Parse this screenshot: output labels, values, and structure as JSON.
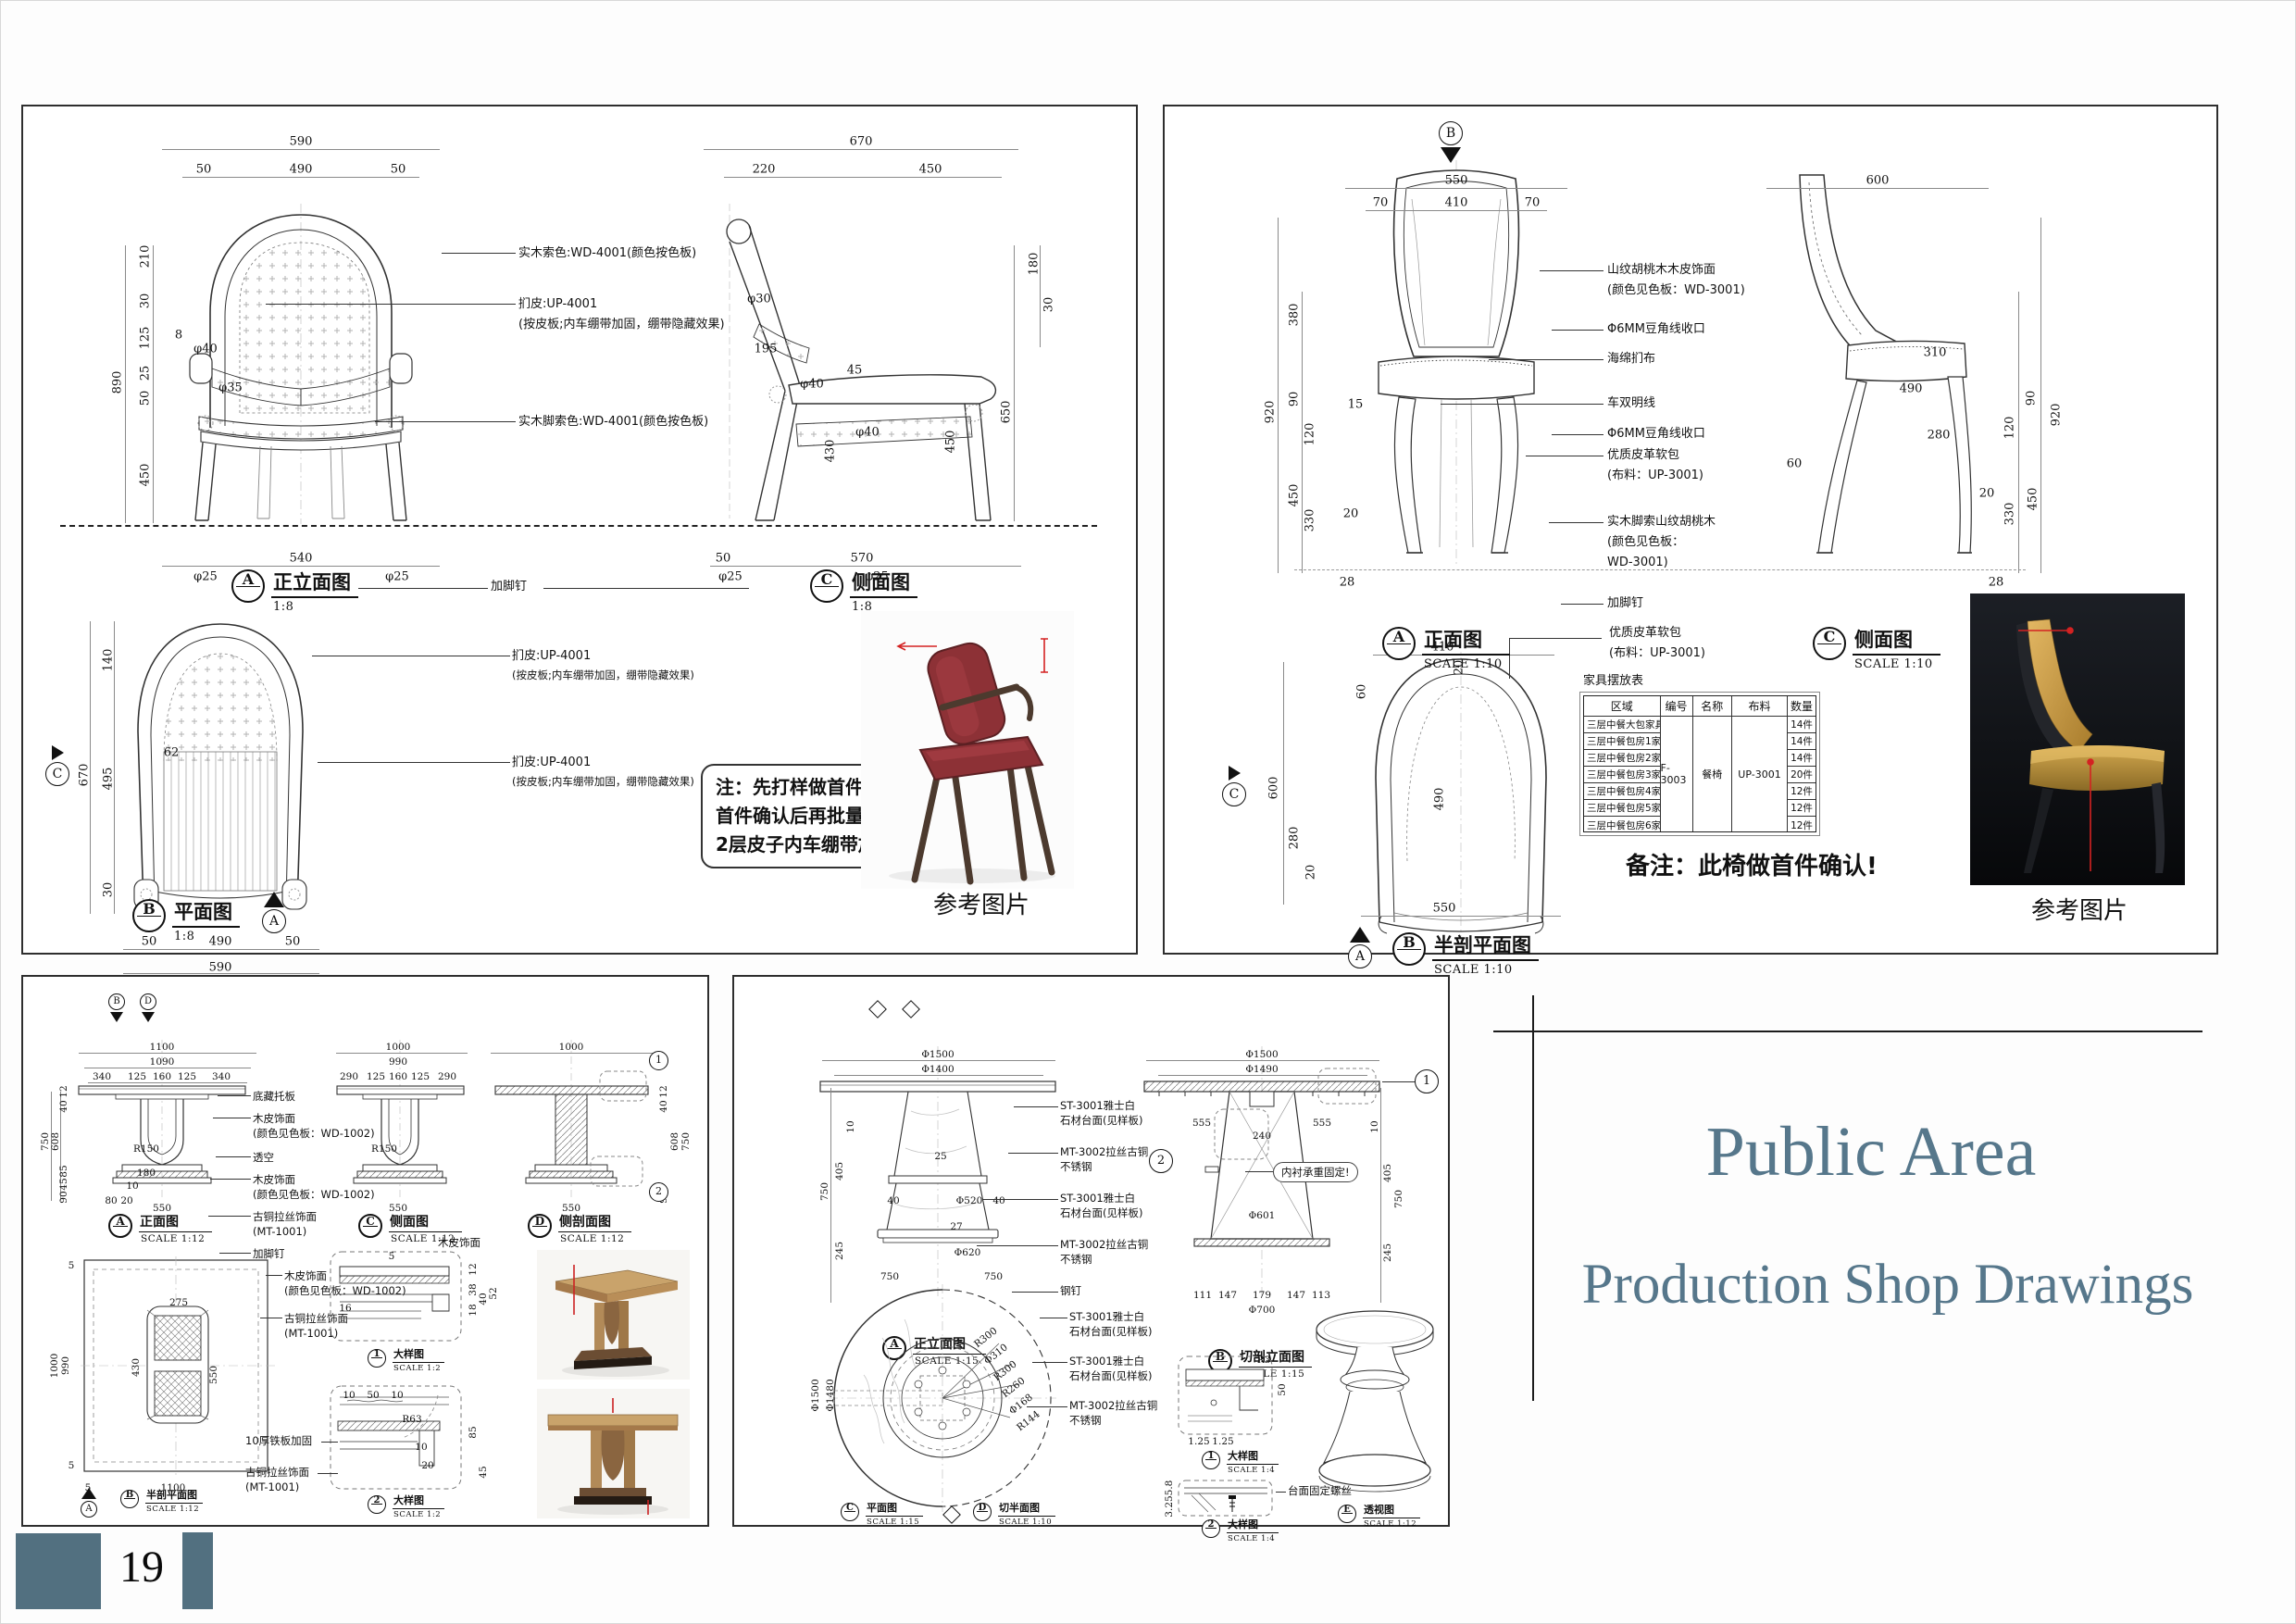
{
  "page": {
    "number": "19"
  },
  "titleblock": {
    "line1": "Public Area",
    "line2": "Production Shop Drawings"
  },
  "common": {
    "photo_caption": "参考图片"
  },
  "armchair": {
    "views": {
      "front": {
        "id": "A",
        "title": "正立面图",
        "scale": "1:8"
      },
      "side": {
        "id": "C",
        "title": "侧面图",
        "scale": "1:8"
      },
      "plan": {
        "id": "B",
        "title": "平面图",
        "scale": "1:8"
      }
    },
    "markers": {
      "plan_dir": "A",
      "section_dir": "C"
    },
    "labels": {
      "wood": "实木索色:WD-4001(颜色按色板)",
      "uph1": "扪皮:UP-4001",
      "uph2": "(按皮板;内车绷带加固，绷带隐藏效果)",
      "leg": "实木脚索色:WD-4001(颜色按色板)",
      "nail": "加脚钉"
    },
    "note": [
      "注：先打样做首件，",
      "首件确认后再批量生产,",
      "2层皮子内车绷带加固"
    ],
    "dims": {
      "front": [
        "590",
        "50",
        "490",
        "50",
        "210",
        "30",
        "125",
        "25",
        "50",
        "890",
        "450",
        "8",
        "φ40",
        "φ35",
        "540",
        "φ25",
        "φ25"
      ],
      "side": [
        "670",
        "220",
        "450",
        "180",
        "30",
        "195",
        "45",
        "φ30",
        "φ40",
        "φ40",
        "650",
        "450",
        "430",
        "50",
        "570",
        "φ25",
        "φ25"
      ],
      "plan": [
        "140",
        "495",
        "30",
        "670",
        "62",
        "50",
        "490",
        "50",
        "590"
      ]
    }
  },
  "diningchair": {
    "views": {
      "front": {
        "id": "A",
        "title": "正面图",
        "scale": "SCALE 1:10"
      },
      "side": {
        "id": "C",
        "title": "侧面图",
        "scale": "SCALE 1:10"
      },
      "halfplan": {
        "id": "B",
        "title": "半剖平面图",
        "scale": "SCALE 1:10"
      }
    },
    "markers": {
      "top": "B",
      "plan_dir": "A",
      "section_dir": "C"
    },
    "labels": {
      "l1a": "山纹胡桃木木皮饰面",
      "l1b": "(颜色见色板：WD-3001)",
      "l2": "Φ6MM豆角线收口",
      "l3": "海绵扪布",
      "l4": "车双明线",
      "l5": "Φ6MM豆角线收口",
      "l6a": "优质皮革软包",
      "l6b": "(布料：UP-3001)",
      "l7a": "实木脚索山纹胡桃木",
      "l7b": "(颜色见色板：",
      "l7c": "WD-3001)",
      "l8": "加脚钉",
      "plan1": "优质皮革软包",
      "plan2": "(布料：UP-3001)"
    },
    "remark": "备注：此椅做首件确认!",
    "table": {
      "title": "家具摆放表",
      "headers": [
        "区域",
        "编号",
        "名称",
        "布料",
        "数量"
      ],
      "code": "F-3003",
      "name": "餐椅",
      "fabric": "UP-3001",
      "rows": [
        {
          "area": "三层中餐大包家具",
          "qty": "14件"
        },
        {
          "area": "三层中餐包房1家具",
          "qty": "14件"
        },
        {
          "area": "三层中餐包房2家具",
          "qty": "14件"
        },
        {
          "area": "三层中餐包房3家具",
          "qty": "20件"
        },
        {
          "area": "三层中餐包房4家具",
          "qty": "12件"
        },
        {
          "area": "三层中餐包房5家具",
          "qty": "12件"
        },
        {
          "area": "三层中餐包房6家具",
          "qty": "12件"
        }
      ]
    },
    "dims": {
      "front": [
        "550",
        "70",
        "410",
        "70",
        "380",
        "90",
        "920",
        "120",
        "15",
        "450",
        "330",
        "20",
        "28"
      ],
      "side": [
        "600",
        "310",
        "490",
        "280",
        "90",
        "920",
        "120",
        "450",
        "330",
        "20",
        "60",
        "28"
      ],
      "plan": [
        "410",
        "20",
        "60",
        "600",
        "280",
        "20",
        "490",
        "550"
      ]
    }
  },
  "squaretable": {
    "views": {
      "front": {
        "id": "A",
        "title": "正面图",
        "scale": "SCALE 1:12"
      },
      "side": {
        "id": "C",
        "title": "侧面图",
        "scale": "SCALE 1:12"
      },
      "section": {
        "id": "D",
        "title": "侧剖面图",
        "scale": "SCALE 1:12"
      },
      "halfplan": {
        "id": "B",
        "title": "半剖平面图",
        "scale": "SCALE 1:12"
      },
      "det1": {
        "id": "1",
        "title": "大样图",
        "scale": "SCALE 1:2"
      },
      "det2": {
        "id": "2",
        "title": "大样图",
        "scale": "SCALE 1:2"
      }
    },
    "markers": {
      "top1": "B",
      "top2": "D",
      "plan_dir": "A",
      "call1": "1",
      "call2": "2"
    },
    "labels": {
      "l1": "底藏托板",
      "l2a": "木皮饰面",
      "l2b": "(颜色见色板：WD-1002)",
      "l3": "透空",
      "l4a": "木皮饰面",
      "l4b": "(颜色见色板：",
      "l4c": "WD-1002)",
      "l5a": "古铜拉丝饰面",
      "l5b": "(MT-1001)",
      "l6": "加脚钉",
      "iron": "10厚铁板加固"
    },
    "dims": {
      "front": [
        "1100",
        "1090",
        "340",
        "125",
        "160",
        "125",
        "340",
        "12",
        "40",
        "750",
        "608",
        "85",
        "45",
        "90",
        "R150",
        "180",
        "10",
        "80",
        "20",
        "550"
      ],
      "side": [
        "1000",
        "990",
        "290",
        "125",
        "160",
        "125",
        "290",
        "R150",
        "550"
      ],
      "section": [
        "1000",
        "12",
        "40",
        "608",
        "750",
        "90",
        "550"
      ],
      "plan": [
        "5",
        "1000",
        "990",
        "5",
        "5",
        "1100",
        "275",
        "430",
        "550"
      ],
      "det1": [
        "5",
        "12",
        "38",
        "18",
        "16",
        "40",
        "52"
      ],
      "det2": [
        "10",
        "50",
        "10",
        "R63",
        "85",
        "10",
        "20",
        "45"
      ]
    }
  },
  "roundtable": {
    "views": {
      "front": {
        "id": "A",
        "title": "正立面图",
        "scale": "SCALE 1:15"
      },
      "section": {
        "id": "B",
        "title": "切剖立面图",
        "scale": "SCALE 1:15"
      },
      "plan": {
        "id": "C",
        "title": "平面图",
        "scale": "SCALE 1:15"
      },
      "halfplan": {
        "id": "D",
        "title": "切半面图",
        "scale": "SCALE 1:10"
      },
      "det1": {
        "id": "1",
        "title": "大样图",
        "scale": "SCALE 1:4"
      },
      "det2": {
        "id": "2",
        "title": "大样图",
        "scale": "SCALE 1:4"
      },
      "persp": {
        "id": "E",
        "title": "透视图",
        "scale": "SCALE 1:12"
      }
    },
    "markers": {
      "call1": "1",
      "call2": "2"
    },
    "labels": {
      "stone1": "ST-3001雅士白",
      "stone2": "石材台面(见样板)",
      "metal1": "MT-3002拉丝古铜",
      "metal2": "不锈钢",
      "nail": "钢钉",
      "inner": "内衬承重固定!",
      "screw": "台面固定螺丝"
    },
    "dims": {
      "front": [
        "Φ1500",
        "Φ1400",
        "750",
        "405",
        "245",
        "10",
        "25",
        "Φ520",
        "27",
        "Φ620",
        "40",
        "40"
      ],
      "section": [
        "Φ1500",
        "Φ1490",
        "555",
        "240",
        "555",
        "Φ601",
        "111",
        "147",
        "179",
        "147",
        "113",
        "Φ700",
        "750",
        "405",
        "245",
        "10"
      ],
      "plan": [
        "Φ1500",
        "Φ1480",
        "750",
        "750",
        "R300",
        "Φ310",
        "R300",
        "R260",
        "Φ168",
        "R144"
      ],
      "det1": [
        "R3",
        "50",
        "1.25",
        "1.25"
      ],
      "det2": [
        "5.8",
        "3.25"
      ]
    }
  }
}
